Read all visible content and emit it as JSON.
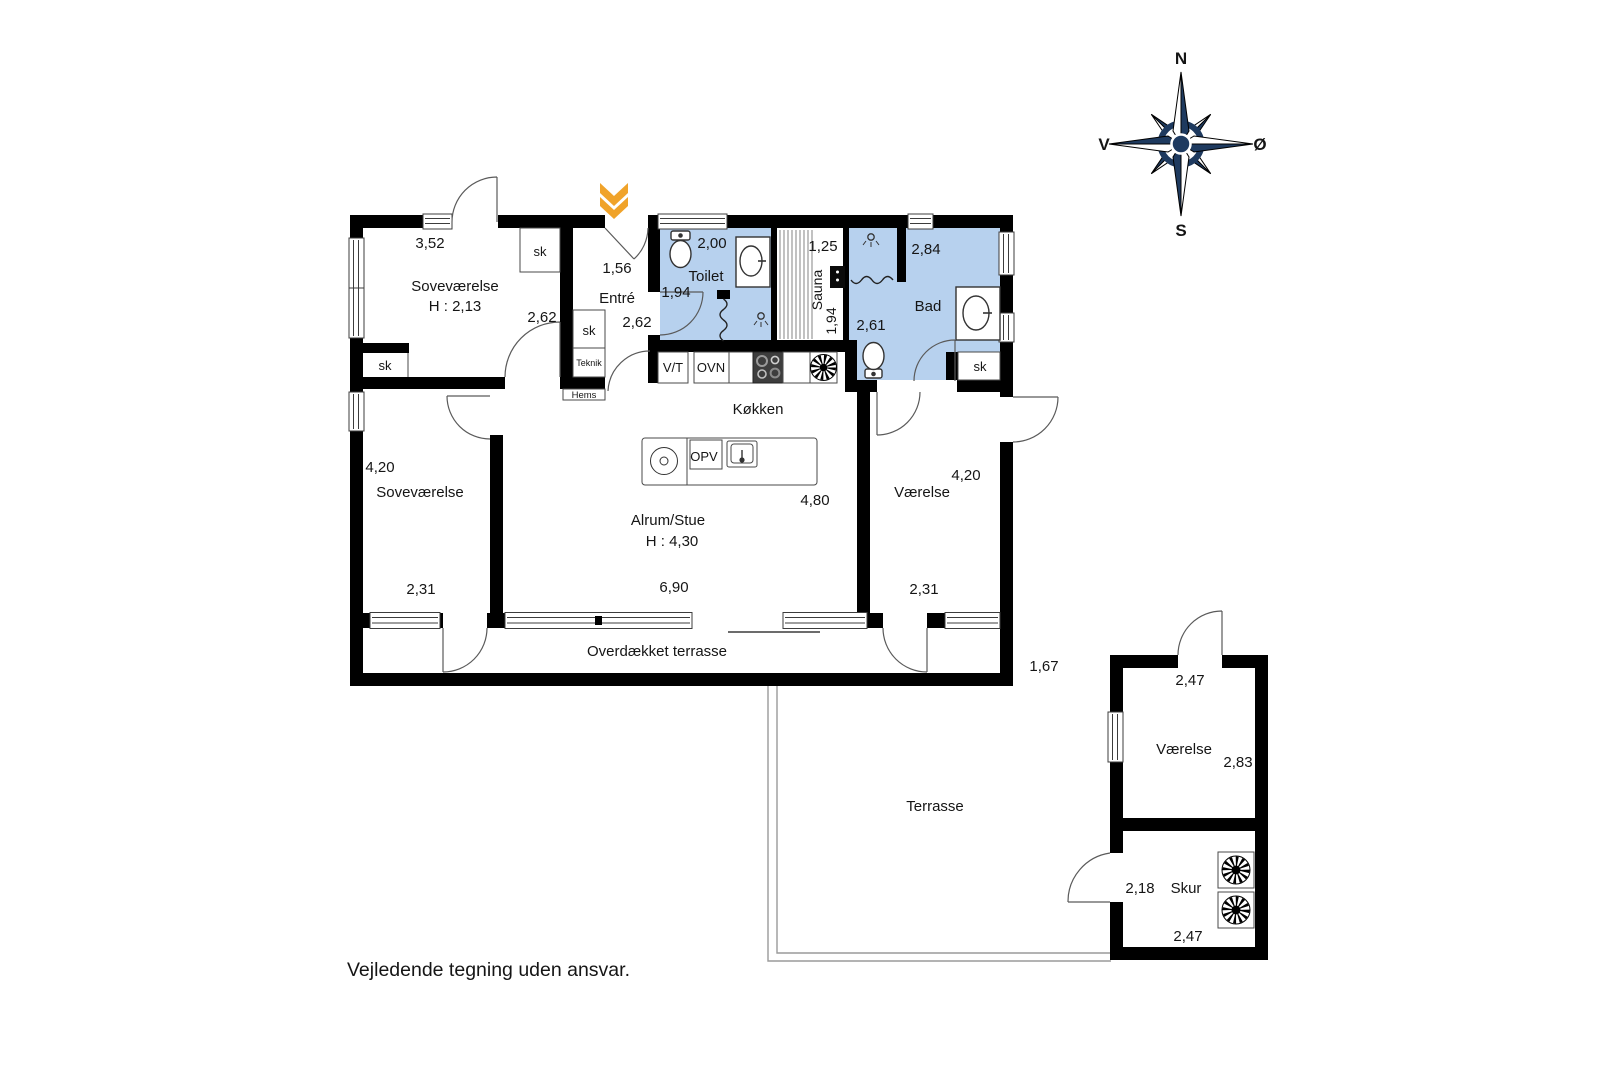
{
  "disclaimer": "Vejledende tegning uden ansvar.",
  "compass": {
    "north": "N",
    "south": "S",
    "west": "V",
    "east": "Ø"
  },
  "colors": {
    "wall_black": "#000000",
    "wet_room_blue": "#b7d1ee",
    "entrance_marker_orange": "#f0a32a",
    "compass_navy": "#1e3a5f"
  },
  "icons": {
    "compass_rose": "compass-rose",
    "entrance_marker": "double-chevron-down",
    "toilet": "toilet-bowl",
    "sink": "oval-sink",
    "stove": "four-burner-stove",
    "extractor_fan": "radial-fan",
    "dishwasher": "round-machine",
    "shower": "shower-head"
  },
  "rooms": {
    "bedroom_nw": {
      "name": "Soveværelse",
      "height": "H : 2,13",
      "dim_w": "3,52",
      "dim_d": "2,62"
    },
    "entre": {
      "name": "Entré",
      "dim_w": "1,56",
      "dim_d": "2,62"
    },
    "toilet": {
      "name": "Toilet",
      "dim_w": "2,00",
      "dim_d": "1,94"
    },
    "sauna": {
      "name": "Sauna",
      "dim_w": "1,25",
      "dim_d": "1,94"
    },
    "bad": {
      "name": "Bad",
      "dim_w": "2,84",
      "dim_d": "2,61"
    },
    "kitchen": {
      "name": "Køkken"
    },
    "living": {
      "name": "Alrum/Stue",
      "height": "H : 4,30",
      "dim_w": "6,90",
      "dim_d": "4,80"
    },
    "bedroom_sw": {
      "name": "Soveværelse",
      "dim_w": "4,20",
      "dim_d": "2,31"
    },
    "room_east": {
      "name": "Værelse",
      "dim_w": "4,20",
      "dim_d": "2,31"
    },
    "covered_terrace": {
      "name": "Overdækket terrasse"
    },
    "terrace": {
      "name": "Terrasse"
    },
    "annex_room": {
      "name": "Værelse",
      "dim_w": "2,47",
      "dim_d": "2,83"
    },
    "shed": {
      "name": "Skur",
      "dim_d": "2,18",
      "dim_w": "2,47"
    }
  },
  "labels": {
    "closet": "sk",
    "teknik": "Teknik",
    "hems": "Hems",
    "vt": "V/T",
    "ovn": "OVN",
    "opv": "OPV",
    "gap_dim": "1,67"
  }
}
